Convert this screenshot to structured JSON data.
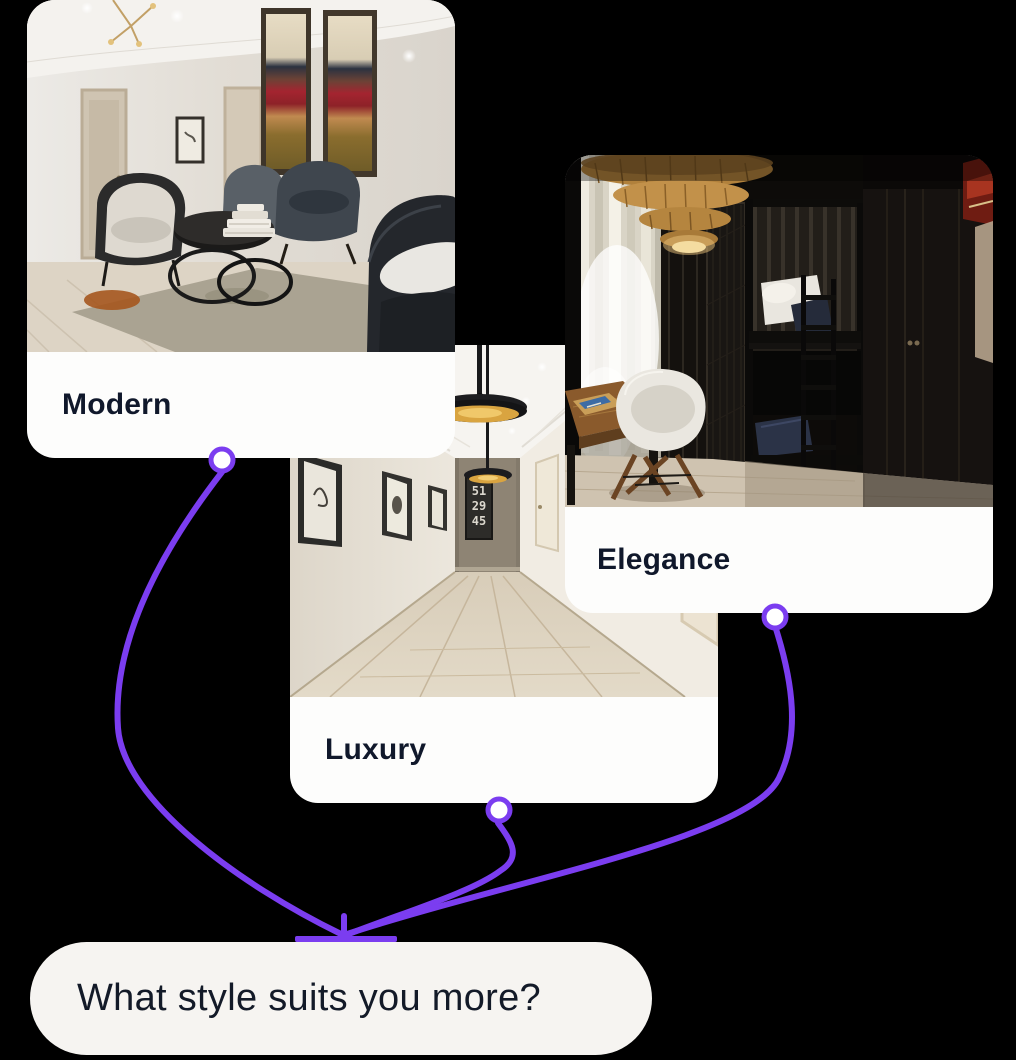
{
  "theme": {
    "background": "#000000",
    "accent_purple": "#7B3DF0",
    "connector_node_fill": "#FFFFFF",
    "card_background": "#FDFDFC",
    "label_text_color": "#10182B",
    "bubble_background": "#F6F4F1",
    "bubble_text_color": "#131A28"
  },
  "style_cards": [
    {
      "label": "Modern",
      "photo_alt": "modern-lounge-with-armchairs-abstract-paintings-round-tables"
    },
    {
      "label": "Luxury",
      "photo_alt": "luxury-hallway-with-black-gold-pendant-lamps-and-framed-art"
    },
    {
      "label": "Elegance",
      "photo_alt": "elegant-dark-bedroom-with-rattan-lamp-bunk-bed-desk-and-chair"
    }
  ],
  "question_bubble": {
    "text": "What style suits you more?"
  },
  "poster_numbers": {
    "line1": "51",
    "line2": "29",
    "line3": "45"
  }
}
